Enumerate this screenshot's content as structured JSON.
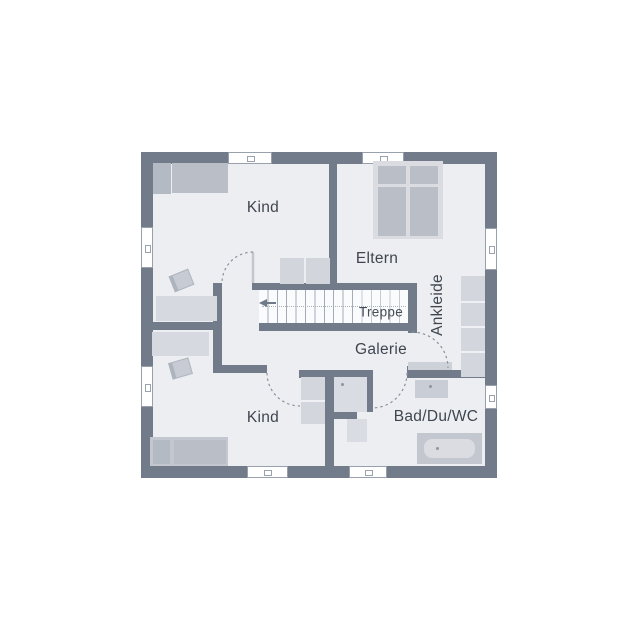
{
  "plan": {
    "type": "floor-plan",
    "rooms": {
      "kind_top": "Kind",
      "eltern": "Eltern",
      "ankleide": "Ankleide",
      "treppe": "Treppe",
      "galerie": "Galerie",
      "kind_bottom": "Kind",
      "bad": "Bad/Du/WC"
    }
  },
  "colors": {
    "bg": "#ffffff",
    "wall": "#717b8a",
    "floor": "#edeef2",
    "furniture_light": "#d6d9df",
    "furniture_medium": "#b9bec7",
    "stair_line": "#a5abb6",
    "door_arc": "#8b929d",
    "text": "#3f454f"
  }
}
